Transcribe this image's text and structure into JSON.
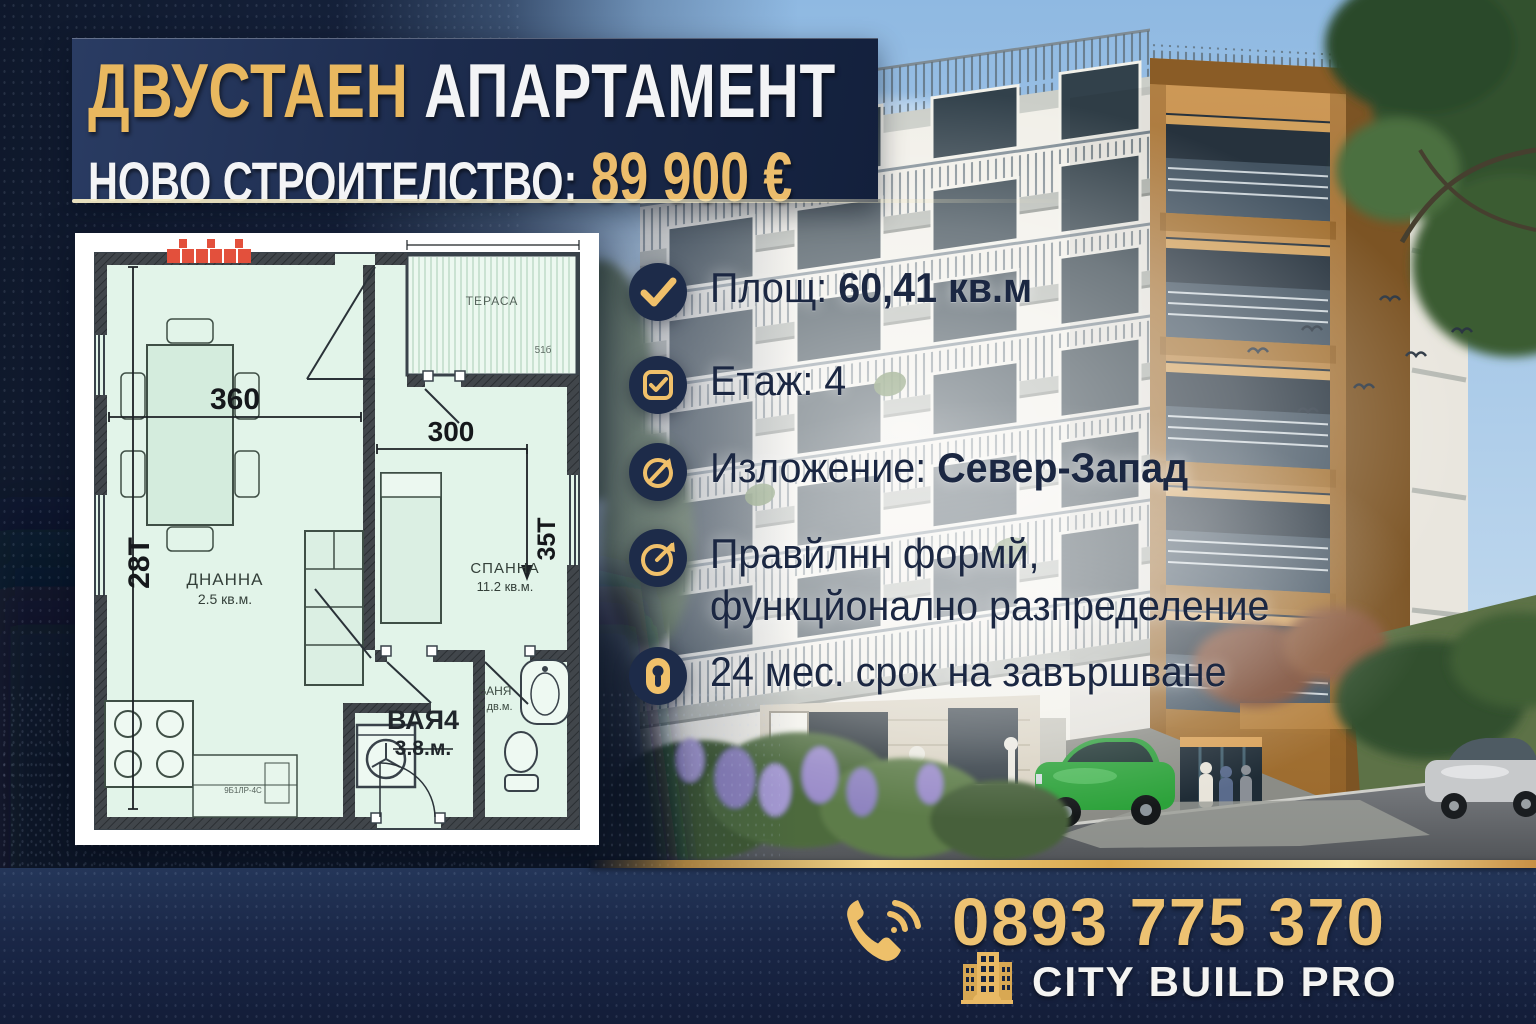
{
  "header": {
    "title_gold": "ДВУСТАЕН",
    "title_white": "АПАРТАМЕНТ",
    "subtitle_white": "НОВО СТРОИТЕЛСТВО:",
    "subtitle_price": "89 900 €"
  },
  "features": [
    {
      "icon": "check-circle-icon",
      "label": "Площ:",
      "value": "60,41 кв.м"
    },
    {
      "icon": "checkbox-icon",
      "label": "Етаж: 4",
      "value": ""
    },
    {
      "icon": "compass-icon",
      "label": "Изложение:",
      "value": "Север-Запад"
    },
    {
      "icon": "gauge-icon",
      "label": "Правйлнн формй,",
      "line2": "функцйонално разпределение"
    },
    {
      "icon": "keyhole-icon",
      "label": "24 мес. срок на завършване"
    }
  ],
  "floorplan": {
    "living": {
      "name": "ДНАННА",
      "area": "2.5 кв.м."
    },
    "bedroom": {
      "name": "СПАННА",
      "area": "11.2 кв.м."
    },
    "bath": {
      "name": "БАНЯ",
      "area": "2 дв.м."
    },
    "hall": {
      "name": "ВАЯ4",
      "area": "3.8.м."
    },
    "balcony": {
      "name": "ТЕРАСА",
      "code": "51б"
    },
    "dims": {
      "width_living": "360",
      "width_bedroom": "300",
      "height_left": "28Т",
      "height_right": "35Т"
    },
    "small_label": "9Б1ЛР-4С"
  },
  "footer": {
    "phone": "0893 775 370",
    "company": "CITY BUILD PRO"
  },
  "colors": {
    "gold": "#E9B85F",
    "navy": "#1C2B4B",
    "text_navy": "#1B2742",
    "plan_mint": "#E2F4E9",
    "wall": "#3B4045",
    "accent_red": "#E3503C"
  }
}
